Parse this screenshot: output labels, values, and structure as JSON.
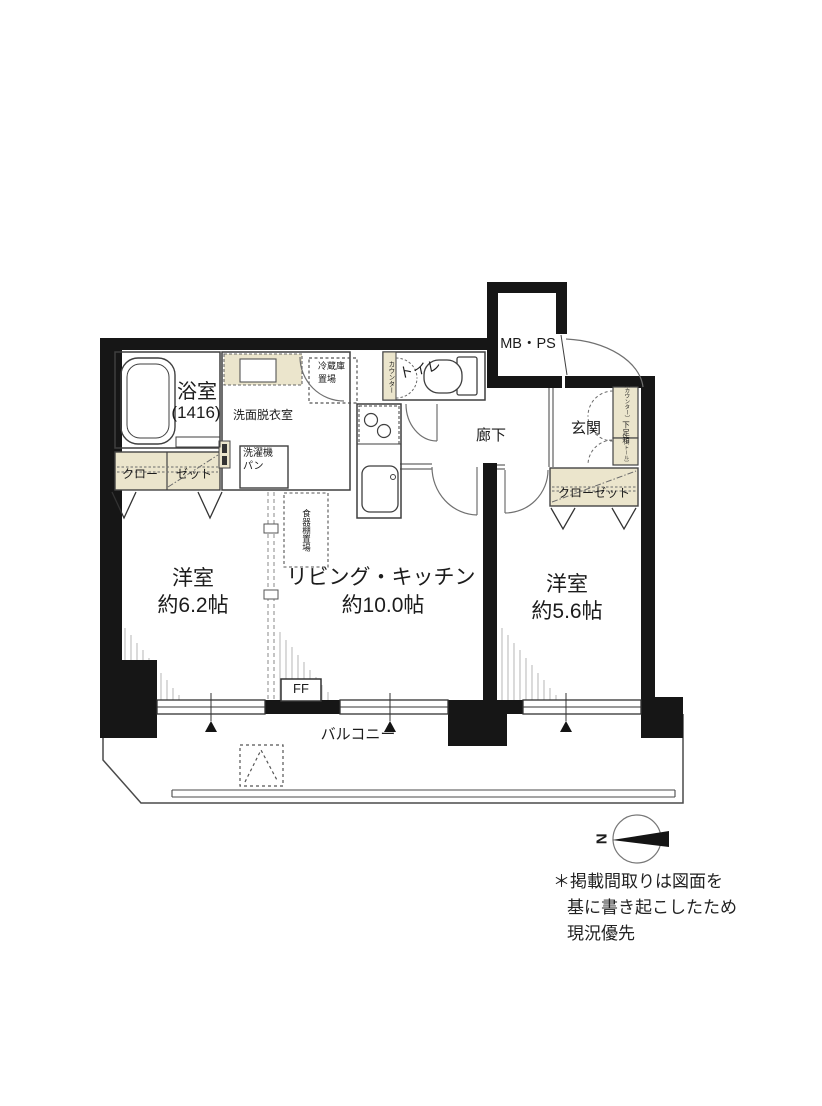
{
  "colors": {
    "wall": "#161616",
    "thin_line": "#3f3f3f",
    "fixture_beige": "#ebe5cc",
    "hatch": "#bdbdbd"
  },
  "rooms": {
    "bath": {
      "name": "浴室",
      "size": "(1416)"
    },
    "washroom": {
      "name": "洗面脱衣室"
    },
    "washer_pan": {
      "line1": "洗濯機",
      "line2": "パン"
    },
    "closet_left": {
      "part1": "クロー",
      "part2": "ゼット"
    },
    "fridge_space": {
      "line1": "冷蔵庫",
      "line2": "置場"
    },
    "counter_toilet": {
      "name": "カウンター"
    },
    "toilet": {
      "name": "トイレ"
    },
    "mb_ps": {
      "name": "MB・PS"
    },
    "hallway": {
      "name": "廊下"
    },
    "entrance": {
      "name": "玄関"
    },
    "shoe_box": {
      "upper_bracket": "〔カウンター〕",
      "upper_main": "下足箱",
      "lower": "〔トール〕"
    },
    "closet_right": {
      "name": "クローゼット"
    },
    "cupboard_space": {
      "name": "食器棚置場"
    },
    "western_left": {
      "name": "洋室",
      "size": "約6.2帖"
    },
    "living_kitchen": {
      "name": "リビング・キッチン",
      "size": "約10.0帖"
    },
    "western_right": {
      "name": "洋室",
      "size": "約5.6帖"
    },
    "balcony": {
      "name": "バルコニー"
    },
    "ff_heater": {
      "name": "FF"
    }
  },
  "compass": {
    "north": "N"
  },
  "disclaimer": {
    "line1": "＊掲載間取りは図面を",
    "line2": "基に書き起こしたため",
    "line3": "現況優先"
  }
}
